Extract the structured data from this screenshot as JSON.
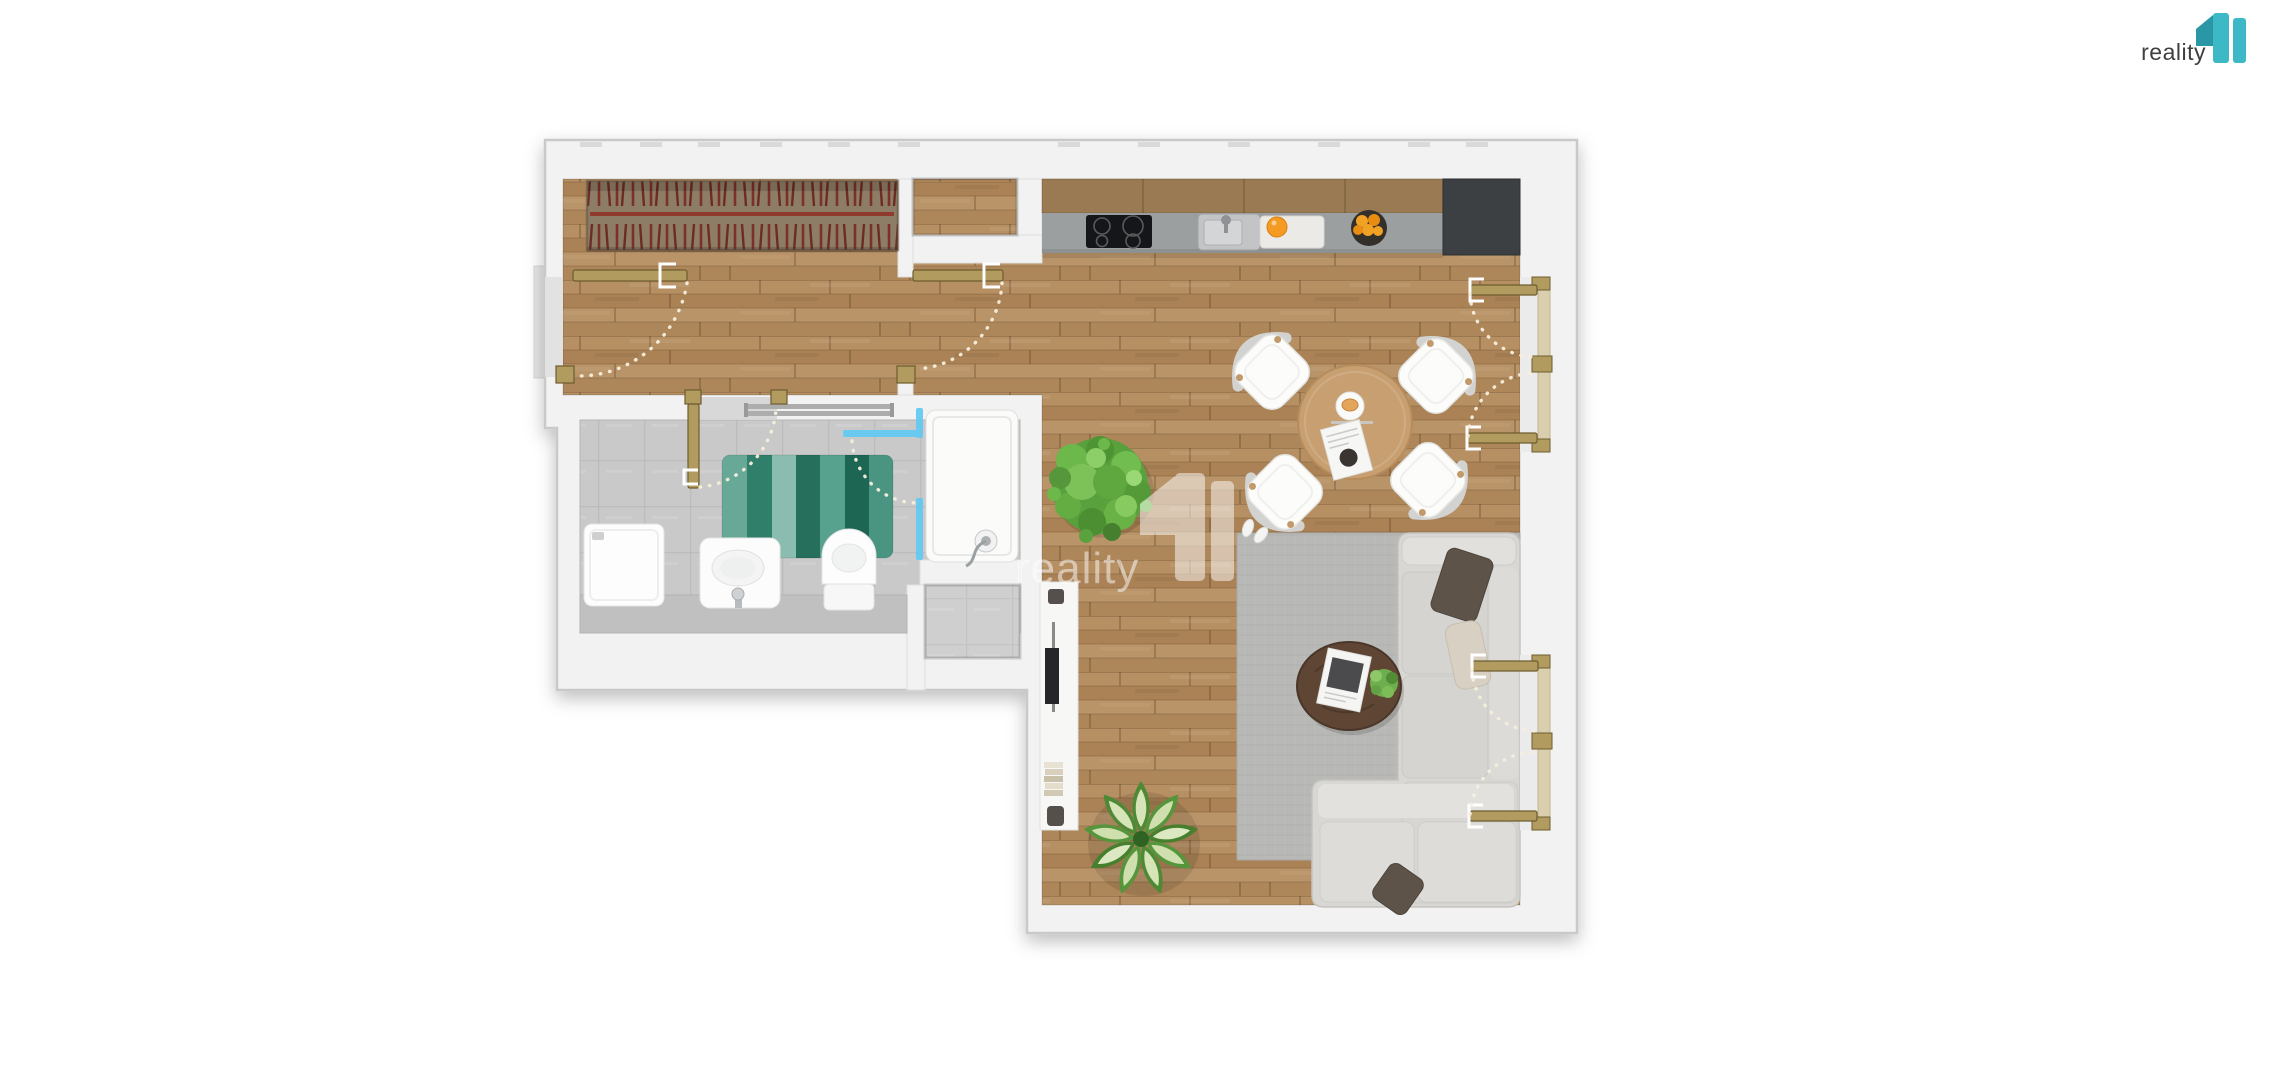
{
  "branding": {
    "logo_text": "reality",
    "logo_mark": "11"
  },
  "watermark": {
    "text": "reality",
    "mark": "11",
    "opacity": 0.5
  },
  "palette": {
    "wall": "#f2f2f2",
    "wall_edge": "#c9c9c9",
    "wood_floor": "#b18a5e",
    "bathroom_tile": "#c9c9c9",
    "mat_teal": "#2f7f6b",
    "shower_glass_blue": "#62c9f2",
    "door_gold": "#b29b5e",
    "door_gold_edge": "#6e5c2e",
    "window_glass": "#d9cfae",
    "counter_gray": "#9c9fa0",
    "cooktop_black": "#15161a",
    "appliance_dark": "#3c4043",
    "sofa_gray": "#d8d7d3",
    "rug_gray": "#b8b8b6",
    "plant_green": "#5ca23f",
    "wardrobe_brown": "#8d7d67",
    "hanger_red": "#7c3128",
    "logo_teal": "#3cb8c6",
    "logo_teal_dark": "#2a97a6",
    "logo_text_color": "#3f3f41",
    "swing_arc_dots": "#f7efdd"
  },
  "scene": {
    "rooms": [
      "hallway",
      "wardrobe",
      "storage-niche",
      "kitchen",
      "dining-area",
      "living-room",
      "bathroom",
      "utility-closet"
    ],
    "doors": [
      "entrance-door",
      "hallway-living-door",
      "bathroom-door",
      "shower-glass-door",
      "french-window-upper",
      "french-window-lower"
    ],
    "furniture": [
      "wardrobe-hangers",
      "kitchen-cabinets",
      "induction-cooktop",
      "kitchen-sink",
      "cutting-board-with-orange",
      "fruit-bowl",
      "refrigerator",
      "round-dining-table",
      "dining-chairs-x4",
      "potted-bush",
      "washing-machine",
      "washbasin",
      "toilet",
      "bath-mat",
      "towel-radiator",
      "shower",
      "area-rug",
      "corner-sofa",
      "throw-pillows",
      "coffee-table",
      "tv-console",
      "floor-plant",
      "slippers"
    ]
  }
}
